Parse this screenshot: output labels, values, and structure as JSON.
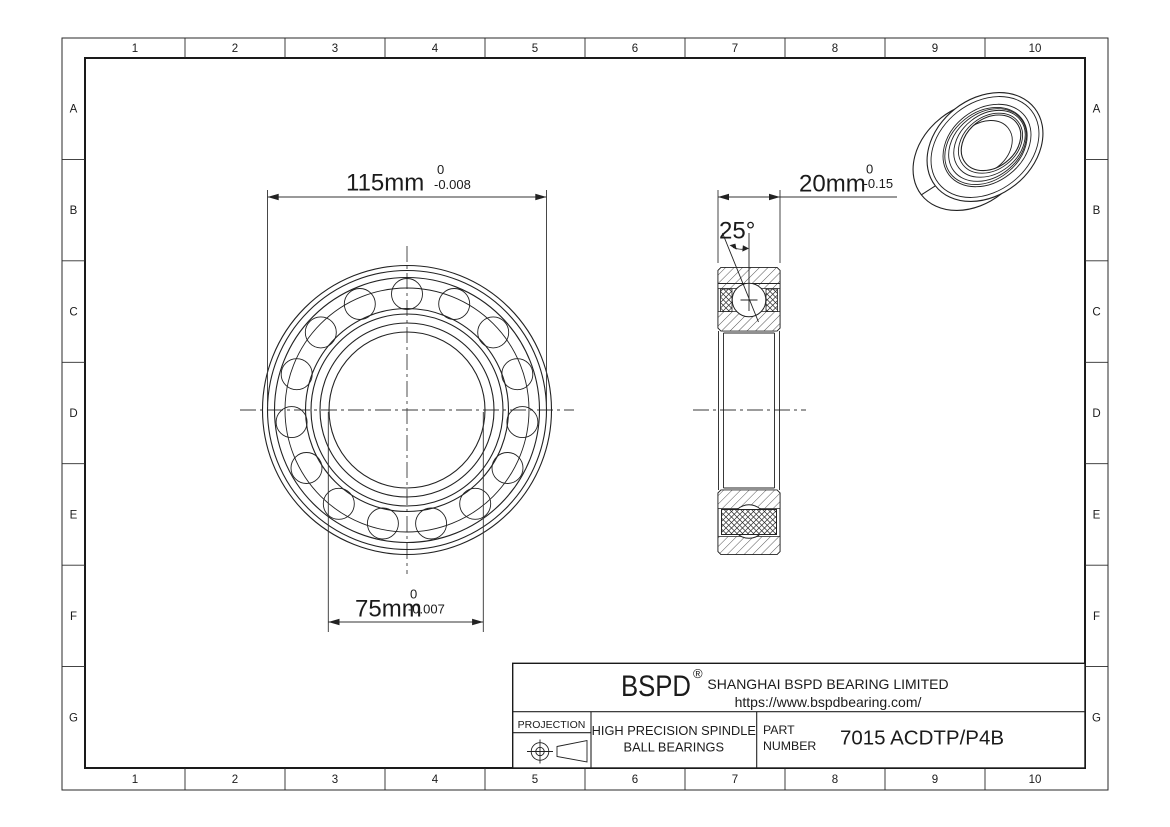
{
  "grid": {
    "columns": [
      "1",
      "2",
      "3",
      "4",
      "5",
      "6",
      "7",
      "8",
      "9",
      "10"
    ],
    "rows": [
      "A",
      "B",
      "C",
      "D",
      "E",
      "F",
      "G"
    ]
  },
  "dimensions": {
    "outer_diameter": {
      "value": "115mm",
      "tol_upper": "0",
      "tol_lower": "-0.008"
    },
    "bore_diameter": {
      "value": "75mm",
      "tol_upper": "0",
      "tol_lower": "-0.007"
    },
    "width": {
      "value": "20mm",
      "tol_upper": "0",
      "tol_lower": "-0.15"
    },
    "contact_angle": {
      "value": "25°"
    }
  },
  "title_block": {
    "logo": "BSPD",
    "registered": "®",
    "company": "SHANGHAI BSPD BEARING LIMITED",
    "website": "https://www.bspdbearing.com/",
    "projection_label": "PROJECTION",
    "product_line1": "HIGH  PRECISION SPINDLE",
    "product_line2": "BALL BEARINGS",
    "part_label1": "PART",
    "part_label2": "NUMBER",
    "part_number": "7015 ACDTP/P4B"
  },
  "colors": {
    "line": "#222222",
    "paper": "#ffffff"
  }
}
